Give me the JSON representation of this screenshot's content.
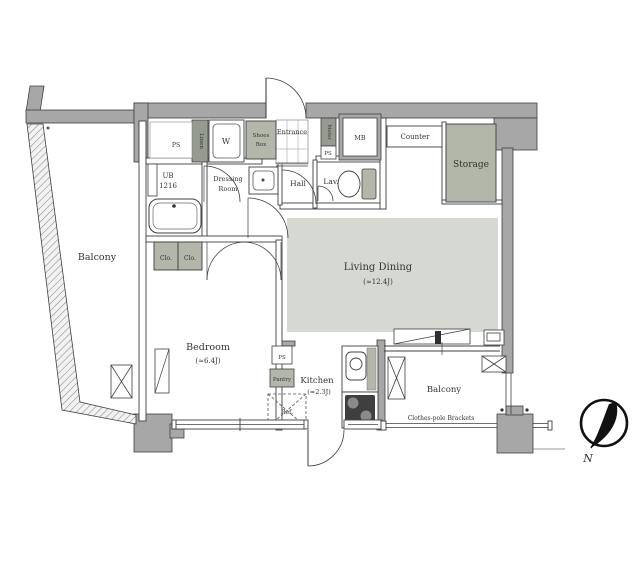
{
  "colors": {
    "wall_gray": "#a7a7a7",
    "shaded_fixture": "#b3b7aa",
    "dark_fixture": "#969b8f",
    "floor_shade": "#d6d8d2",
    "line_dark": "#3f3f3f",
    "compass_black": "#111111"
  },
  "rooms": {
    "balcony_left": {
      "label": "Balcony"
    },
    "bedroom": {
      "label": "Bedroom",
      "size": "(≈6.4J)"
    },
    "living_dining": {
      "label": "Living Dining",
      "size": "(≈12.4J)"
    },
    "kitchen": {
      "label": "Kitchen",
      "size": "(≈2.3J)"
    },
    "balcony_right": {
      "label": "Balcony"
    },
    "hall": {
      "label": "Hall"
    },
    "lavatory": {
      "label": "Lav."
    },
    "dressing_room": {
      "line1": "Dressing",
      "line2": "Room"
    },
    "unit_bath": {
      "line1": "UB",
      "line2": "1216"
    },
    "entrance": {
      "label": "Entrance"
    },
    "storage": {
      "label": "Storage"
    }
  },
  "fixtures": {
    "shoes_box": {
      "line1": "Shoes",
      "line2": "Box"
    },
    "washing_machine": {
      "label": "W"
    },
    "linen": {
      "label": "Linen"
    },
    "meter": {
      "label": "Meter"
    },
    "meter_box": {
      "label": "MB"
    },
    "counter": {
      "label": "Counter"
    },
    "pantry": {
      "label": "Pantry"
    },
    "refrigerator": {
      "label": "Ref."
    },
    "closet1": {
      "label": "Clo."
    },
    "closet2": {
      "label": "Clo."
    },
    "ps_top": {
      "label": "PS"
    },
    "ps_entry": {
      "label": "PS"
    },
    "ps_kitchen": {
      "label": "PS"
    },
    "clothes_pole": {
      "label": "Clothes-pole Brackets"
    }
  },
  "compass": {
    "north_label": "N"
  }
}
